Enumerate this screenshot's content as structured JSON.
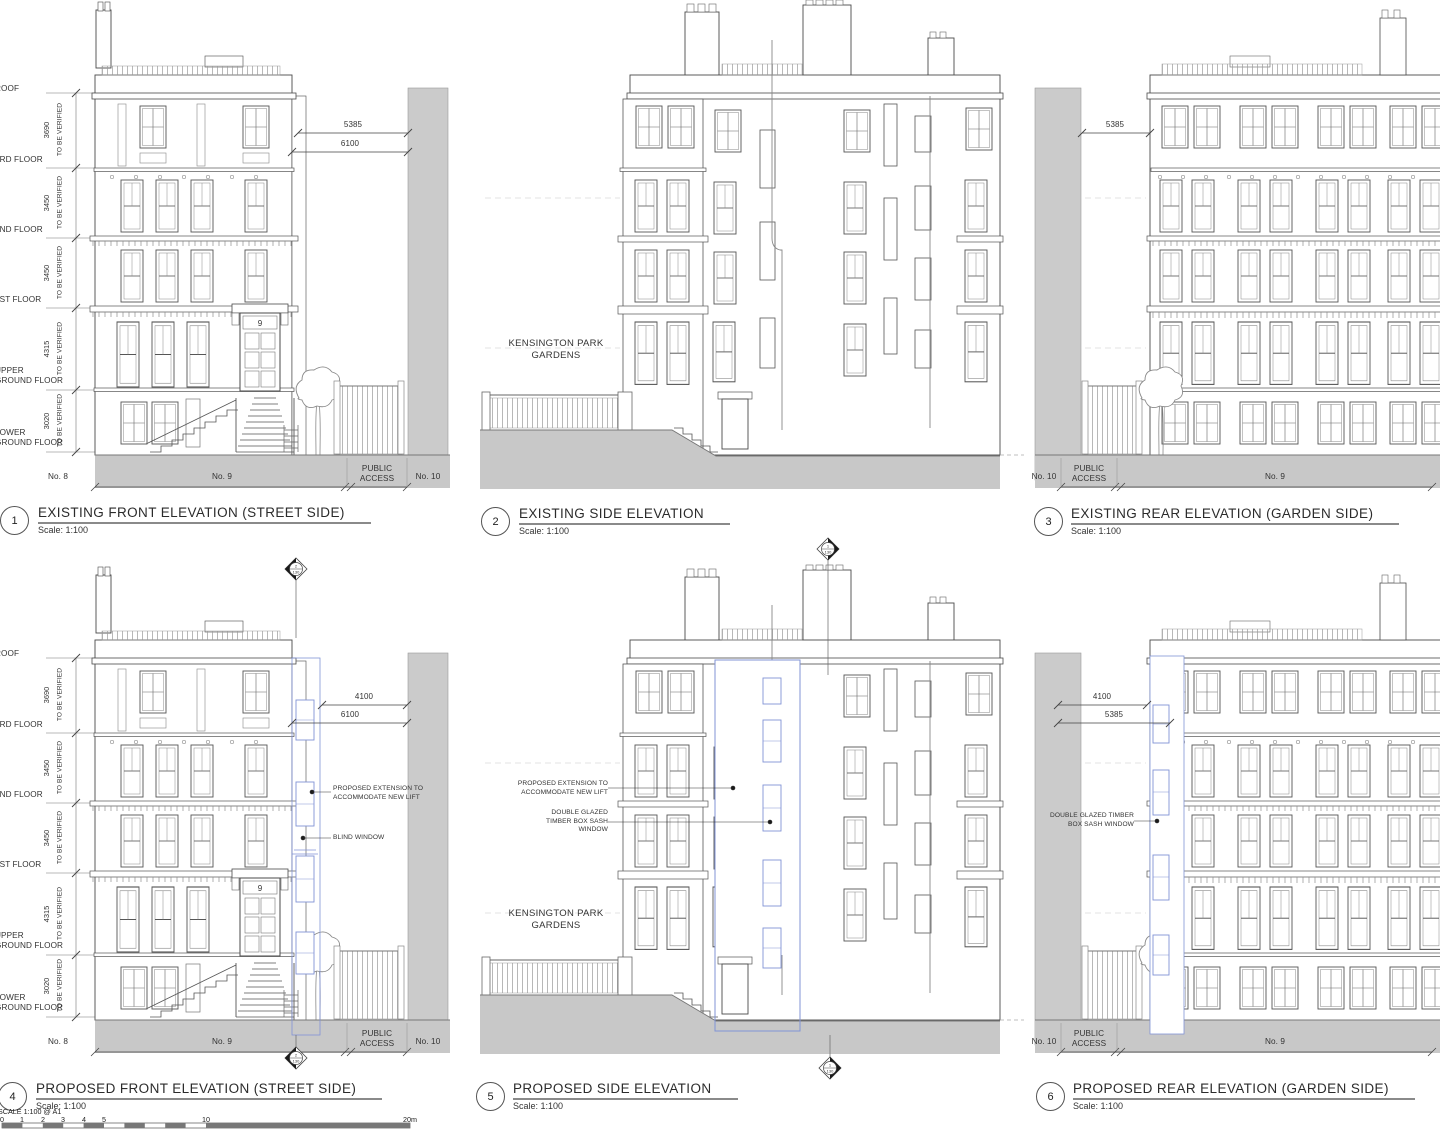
{
  "titles": [
    {
      "num": "1",
      "title": "EXISTING FRONT ELEVATION (STREET SIDE)",
      "scale": "Scale: 1:100"
    },
    {
      "num": "2",
      "title": "EXISTING SIDE ELEVATION",
      "scale": "Scale: 1:100"
    },
    {
      "num": "3",
      "title": "EXISTING REAR ELEVATION (GARDEN SIDE)",
      "scale": "Scale: 1:100"
    },
    {
      "num": "4",
      "title": "PROPOSED FRONT ELEVATION (STREET SIDE)",
      "scale": "Scale: 1:100"
    },
    {
      "num": "5",
      "title": "PROPOSED SIDE ELEVATION",
      "scale": "Scale: 1:100"
    },
    {
      "num": "6",
      "title": "PROPOSED REAR ELEVATION (GARDEN SIDE)",
      "scale": "Scale: 1:100"
    }
  ],
  "levels": {
    "roof": "ROOF",
    "f3": "3RD FLOOR",
    "f2": "2ND FLOOR",
    "f1": "1ST FLOOR",
    "ug": "UPPER\nGROUND FLOOR",
    "lg": "LOWER\nGROUND FLOOR",
    "d1": "3690",
    "d2": "3450",
    "d3": "3450",
    "d4": "4315",
    "d5": "3020",
    "note": "TO BE VERIFIED"
  },
  "dims": {
    "v5385": "5385",
    "v6100": "6100",
    "v4100": "4100"
  },
  "site": {
    "no8": "No. 8",
    "no9": "No. 9",
    "no10": "No. 10",
    "public_access": "PUBLIC\nACCESS",
    "street": "KENSINGTON PARK\nGARDENS",
    "house_number": "9"
  },
  "notes": {
    "lift": "PROPOSED EXTENSION TO\nACCOMMODATE NEW LIFT",
    "blind": "BLIND WINDOW",
    "sash3": "DOUBLE GLAZED\nTIMBER BOX SASH\nWINDOW",
    "sash2": "DOUBLE GLAZED TIMBER\nBOX SASH WINDOW"
  },
  "markers": {
    "front": "2",
    "side": "1",
    "sheet": "130"
  },
  "scale_bar": {
    "label": "SCALE 1:100 @ A1",
    "ticks": [
      "0",
      "1",
      "2",
      "3",
      "4",
      "5",
      "10",
      "20m"
    ]
  }
}
